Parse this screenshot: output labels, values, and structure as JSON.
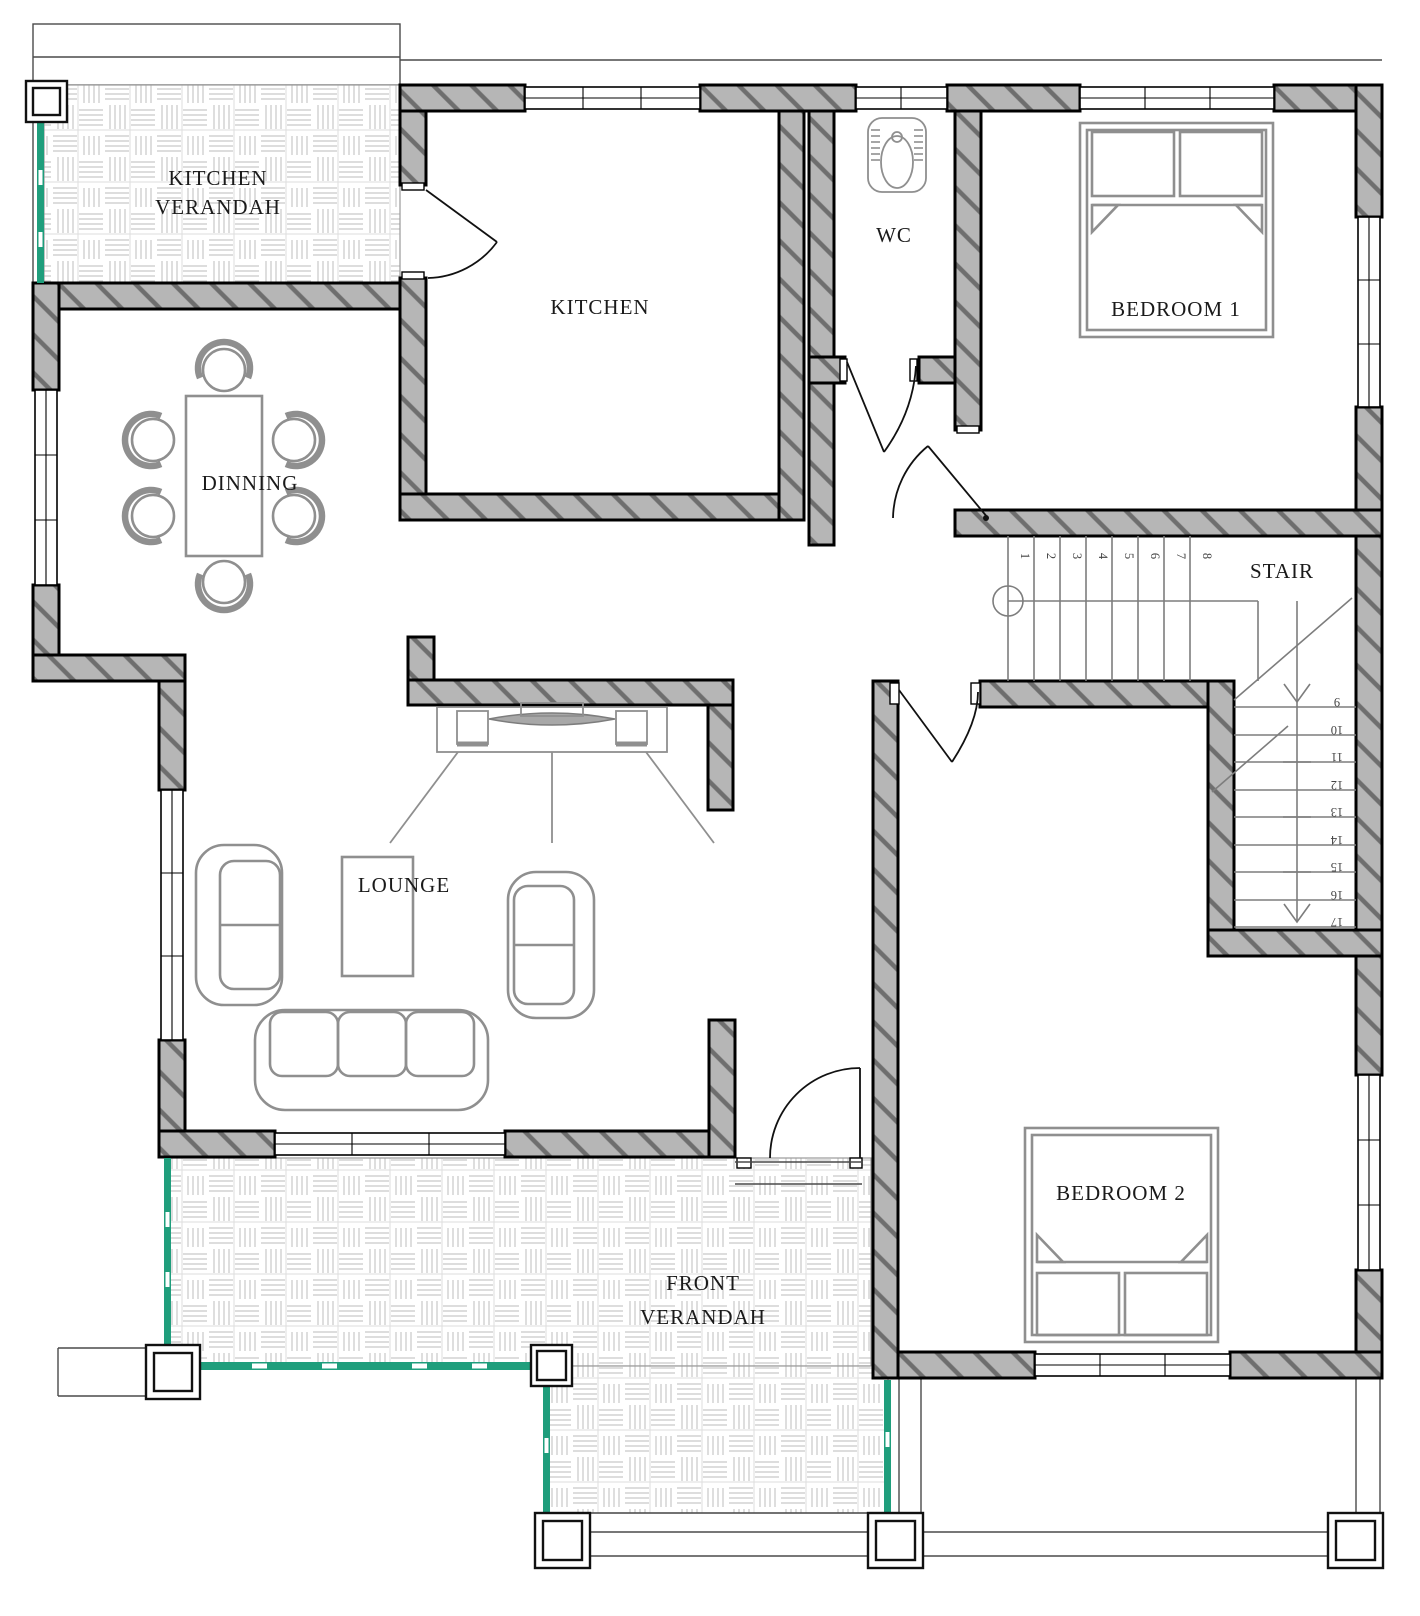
{
  "document": {
    "type": "architectural-floor-plan"
  },
  "rooms": {
    "kitchen_verandah": {
      "line1": "KITCHEN",
      "line2": "VERANDAH"
    },
    "kitchen": {
      "label": "KITCHEN"
    },
    "wc": {
      "label": "WC"
    },
    "bedroom1": {
      "label": "BEDROOM 1"
    },
    "dinning": {
      "label": "DINNING"
    },
    "stair": {
      "label": "STAIR"
    },
    "lounge": {
      "label": "LOUNGE"
    },
    "bedroom2": {
      "label": "BEDROOM 2"
    },
    "front_verandah": {
      "line1": "FRONT",
      "line2": "VERANDAH"
    }
  },
  "stair": {
    "numbers": [
      "1",
      "2",
      "3",
      "4",
      "5",
      "6",
      "7",
      "8",
      "9",
      "10",
      "11",
      "12",
      "13",
      "14",
      "15",
      "16",
      "17"
    ]
  },
  "colors": {
    "wall_fill": "#b6b6b6",
    "wall_hatch": "#6e6e6e",
    "outline": "#000000",
    "furniture": "#8f8f8f",
    "railing_green": "#1f9e7c",
    "weave_line": "#c9c9c9",
    "thin_line": "#4a4a4a",
    "label_ink": "#1a1a1a"
  }
}
